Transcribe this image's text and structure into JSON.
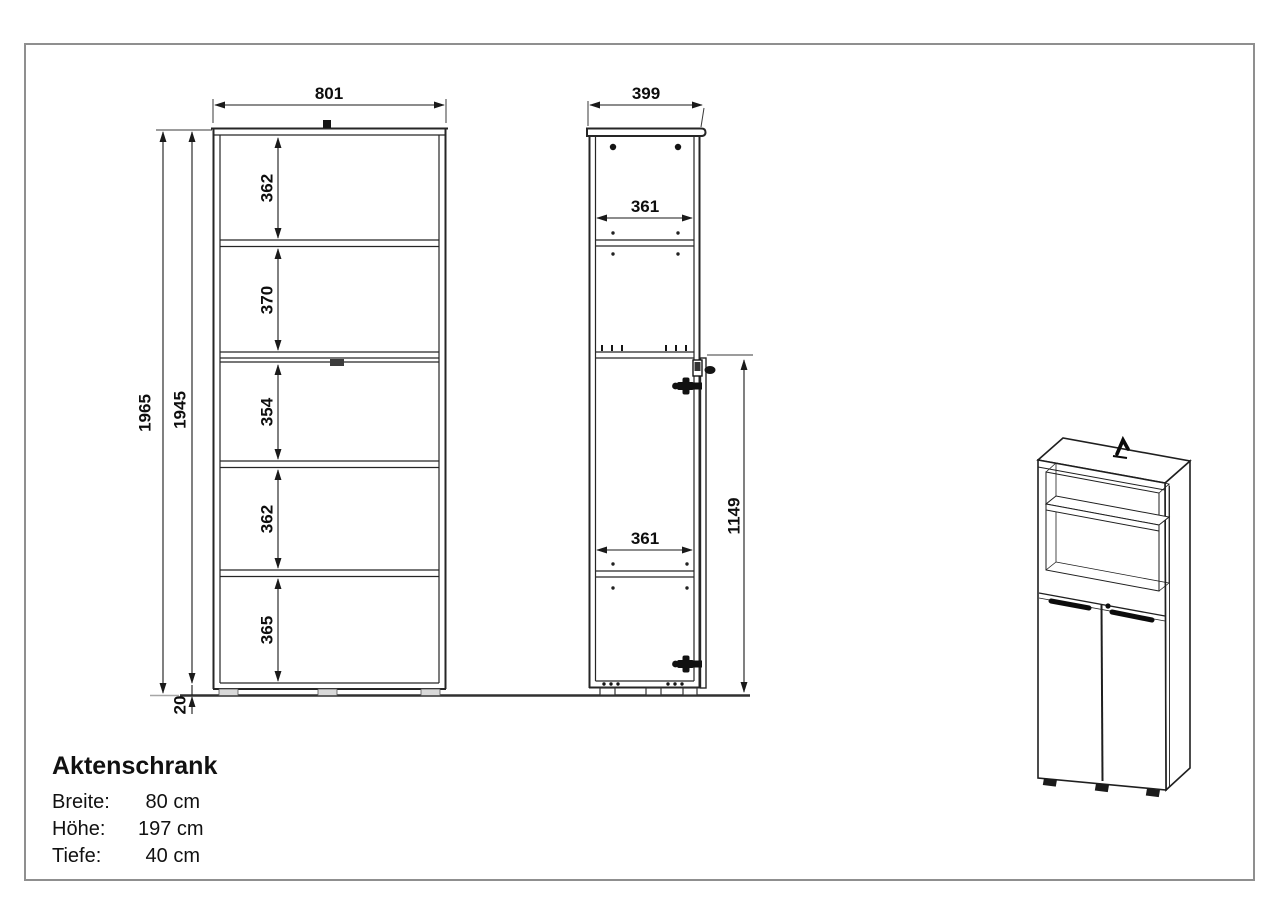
{
  "drawing": {
    "title": "Aktenschrank",
    "specs": [
      {
        "label": "Breite:",
        "value": "80 cm"
      },
      {
        "label": "Höhe:",
        "value": "197 cm"
      },
      {
        "label": "Tiefe:",
        "value": "40 cm"
      }
    ],
    "front_view": {
      "width": "801",
      "total_height": "1965",
      "carcass_height": "1945",
      "plinth_height": "20",
      "sections": [
        "362",
        "370",
        "354",
        "362",
        "365"
      ]
    },
    "side_view": {
      "depth": "399",
      "inner_depth_top": "361",
      "inner_depth_bottom": "361",
      "door_height": "1149"
    },
    "colors": {
      "line": "#262626",
      "frame_border": "#8f8f8f",
      "background": "#ffffff"
    }
  }
}
